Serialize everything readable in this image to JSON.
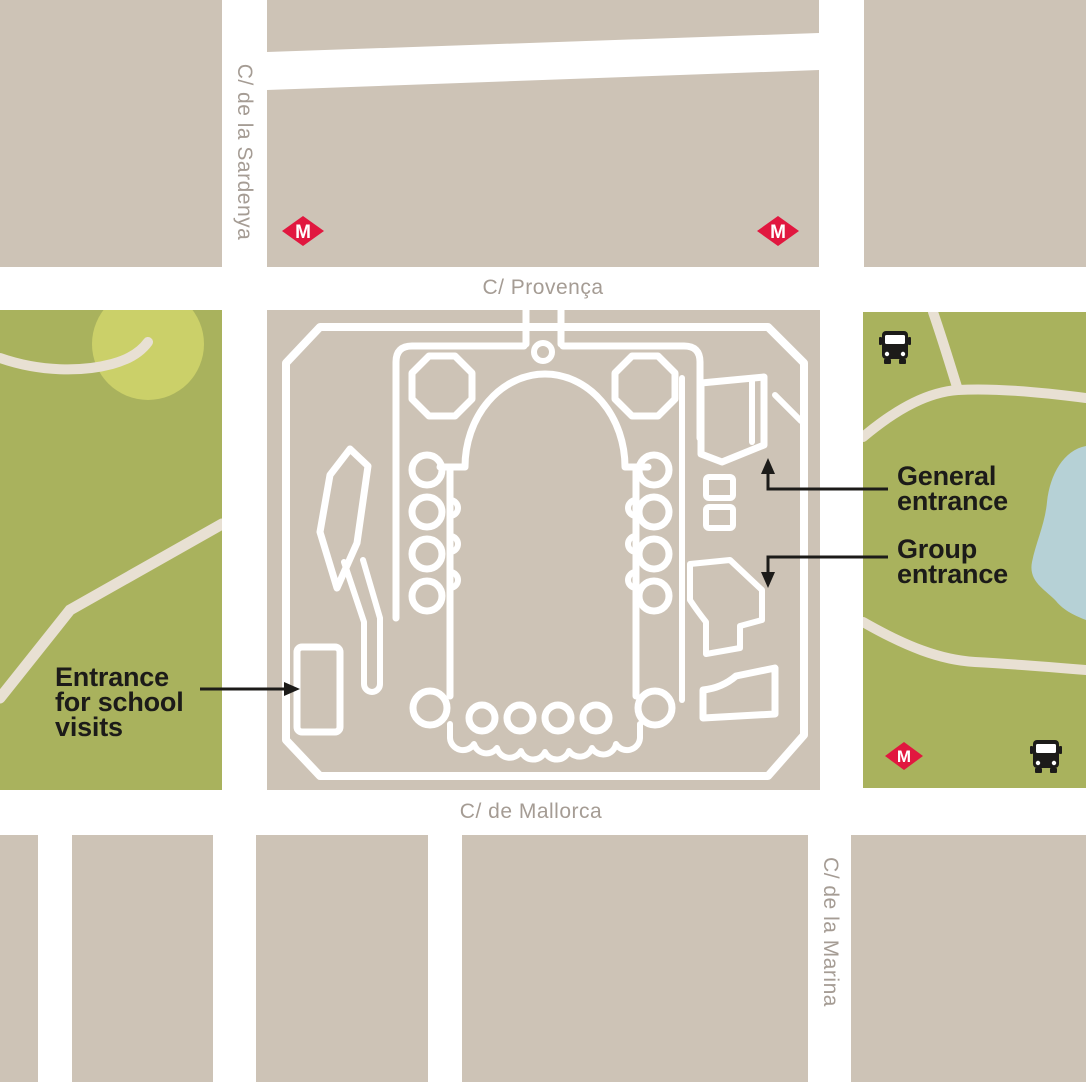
{
  "colors": {
    "bg": "#ffffff",
    "block": "#cdc3b6",
    "park": "#a9b25d",
    "park-circle": "#cbd069",
    "path": "#e8e0d3",
    "pond": "#b6d1d6",
    "metro": "#e1173f",
    "street-text": "#a59c94",
    "ink": "#1c1b19",
    "outline": "#ffffff"
  },
  "streets": {
    "provenca": "C/ Provença",
    "sardenya": "C/ de la Sardenya",
    "mallorca": "C/ de Mallorca",
    "marina": "C/ de la Marina"
  },
  "annotations": {
    "general_entrance": {
      "lines": [
        "General",
        "entrance"
      ]
    },
    "group_entrance": {
      "lines": [
        "Group",
        "entrance"
      ]
    },
    "school_entrance": {
      "lines": [
        "Entrance",
        "for school",
        "visits"
      ]
    }
  },
  "icons": {
    "metro_label": "M",
    "metro_icon": "metro-diamond-icon",
    "bus_icon": "bus-icon"
  }
}
